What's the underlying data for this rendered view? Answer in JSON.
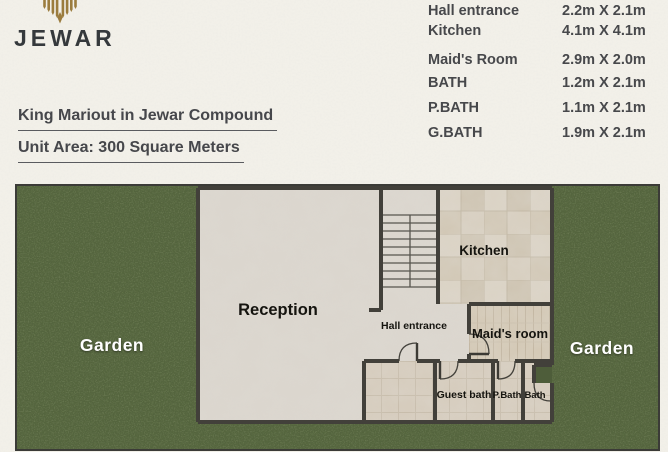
{
  "brand": {
    "name": "JEWAR",
    "logo_icon": "palm-crest-icon",
    "logo_color": "#9b7c3e"
  },
  "titles": {
    "line1": "King Mariout in Jewar Compound",
    "line2": "Unit Area: 300 Square Meters"
  },
  "dimensions_table": {
    "rows": [
      {
        "room": "Hall entrance",
        "size": "2.2m X 2.1m"
      },
      {
        "room": "Kitchen",
        "size": "4.1m X 4.1m"
      },
      {
        "room": "Maid's Room",
        "size": "2.9m X 2.0m"
      },
      {
        "room": "BATH",
        "size": "1.2m X 2.1m"
      },
      {
        "room": "P.BATH",
        "size": "1.1m X 2.1m"
      },
      {
        "room": "G.BATH",
        "size": "1.9m X 2.1m"
      }
    ]
  },
  "floor_plan": {
    "labels": {
      "garden_left": "Garden",
      "garden_right": "Garden",
      "reception": "Reception",
      "kitchen": "Kitchen",
      "hall_entrance": "Hall entrance",
      "maids_room": "Maid's room",
      "guest_bath": "Guest bath",
      "p_bath": "P.Bath",
      "bath": "Bath"
    },
    "colors": {
      "grass": "#53623e",
      "marble": "#dbd6ce",
      "kitchen_tile": "#d6cdbe",
      "bath_tile": "#d6ccbd",
      "wall": "#42403a",
      "room_label": "#15140f",
      "garden_label": "#ffffff"
    }
  }
}
